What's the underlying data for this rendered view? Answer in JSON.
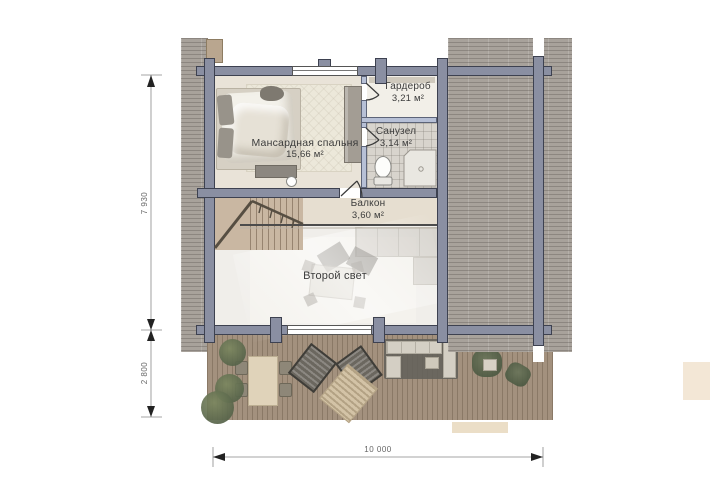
{
  "plan": {
    "rooms": {
      "bedroom": {
        "name": "Мансардная спальня",
        "area": "15,66 м²"
      },
      "wardrobe": {
        "name": "Гардероб",
        "area": "3,21 м²"
      },
      "bathroom": {
        "name": "Санузел",
        "area": "3,14 м²"
      },
      "balcony": {
        "name": "Балкон",
        "area": "3,60 м²"
      },
      "second_light": {
        "name": "Второй свет"
      }
    },
    "dimensions": {
      "left_upper": "7 930",
      "left_lower": "2 800",
      "bottom": "10 000"
    },
    "colors": {
      "log_wall": "#8a8fa2",
      "partition": "#b7c0d6",
      "roof": "#a8a29b",
      "deck": "#a3917e",
      "floor": "#e9e3d8",
      "dimension": "#666666"
    }
  }
}
